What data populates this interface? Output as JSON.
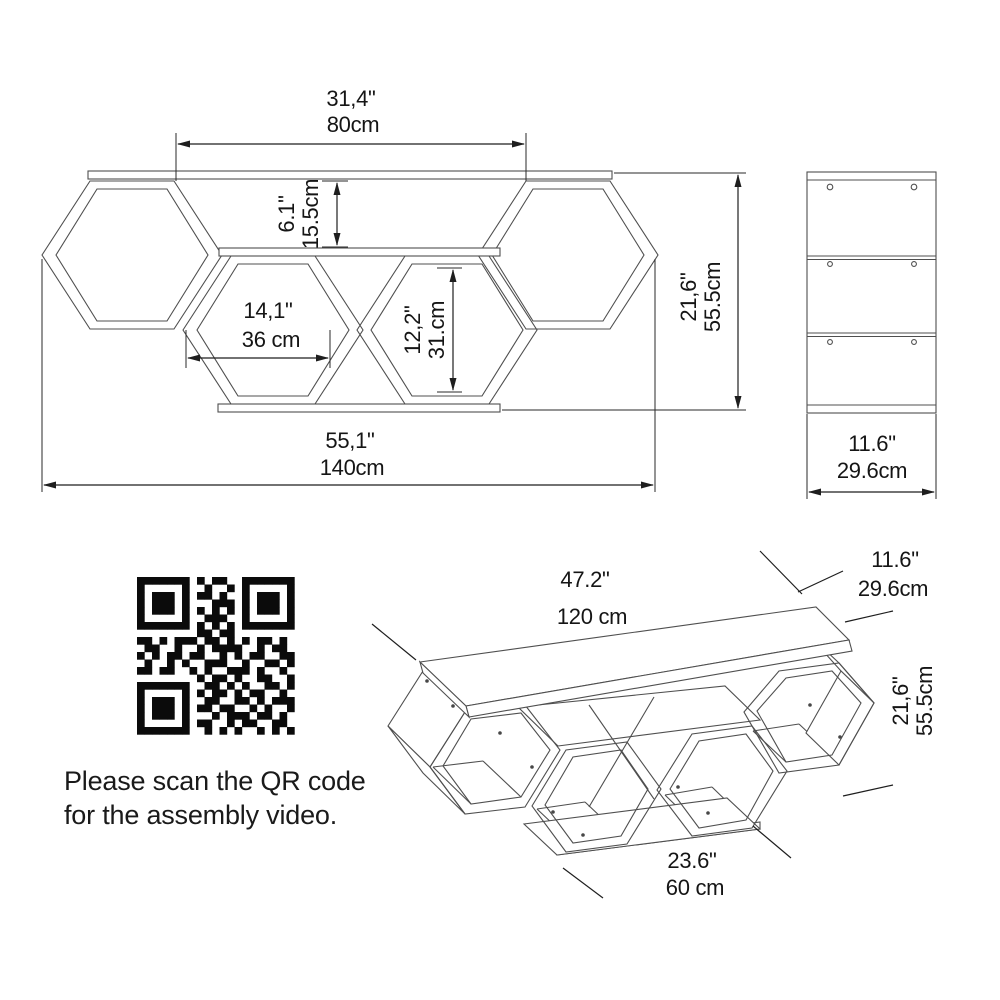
{
  "front_view": {
    "width_top": {
      "inches": "31,4\"",
      "cm": "80cm"
    },
    "shelf_gap": {
      "inches": "6.1\"",
      "cm": "15.5cm"
    },
    "cell_width": {
      "inches": "14,1\"",
      "cm": "36 cm"
    },
    "cell_height": {
      "inches": "12,2\"",
      "cm": "31.cm"
    },
    "total_height": {
      "inches": "21,6\"",
      "cm": "55.5cm"
    },
    "total_width": {
      "inches": "55,1\"",
      "cm": "140cm"
    }
  },
  "side_view": {
    "depth": {
      "inches": "11.6\"",
      "cm": "29.6cm"
    }
  },
  "iso_view": {
    "top_length": {
      "inches": "47.2\"",
      "cm": "120 cm"
    },
    "depth": {
      "inches": "11.6\"",
      "cm": "29.6cm"
    },
    "height": {
      "inches": "21,6\"",
      "cm": "55.5cm"
    },
    "bottom_length": {
      "inches": "23.6\"",
      "cm": "60 cm"
    }
  },
  "note": {
    "line1": "Please scan the QR code",
    "line2": "for the assembly video."
  },
  "colors": {
    "line": "#4f4f4f",
    "dimension": "#1e1e1e",
    "text": "#151515",
    "background": "#ffffff"
  },
  "qr_matrix": [
    "111111101011001111111",
    "100000100100101000001",
    "101110101101001011101",
    "101110100011101011101",
    "101110101010101011101",
    "100000100111001000001",
    "111111101010101111111",
    "000000001101100000000",
    "110101110110101011010",
    "011001001011110010110",
    "101011011001010110011",
    "010010100111001001101",
    "110110010100111010010",
    "000000001011010011001",
    "111111100110101001101",
    "100000101011010110010",
    "101110100110011010111",
    "101110101101100101001",
    "101110100010111011010",
    "100000101100101100110",
    "111111100101010010101"
  ]
}
